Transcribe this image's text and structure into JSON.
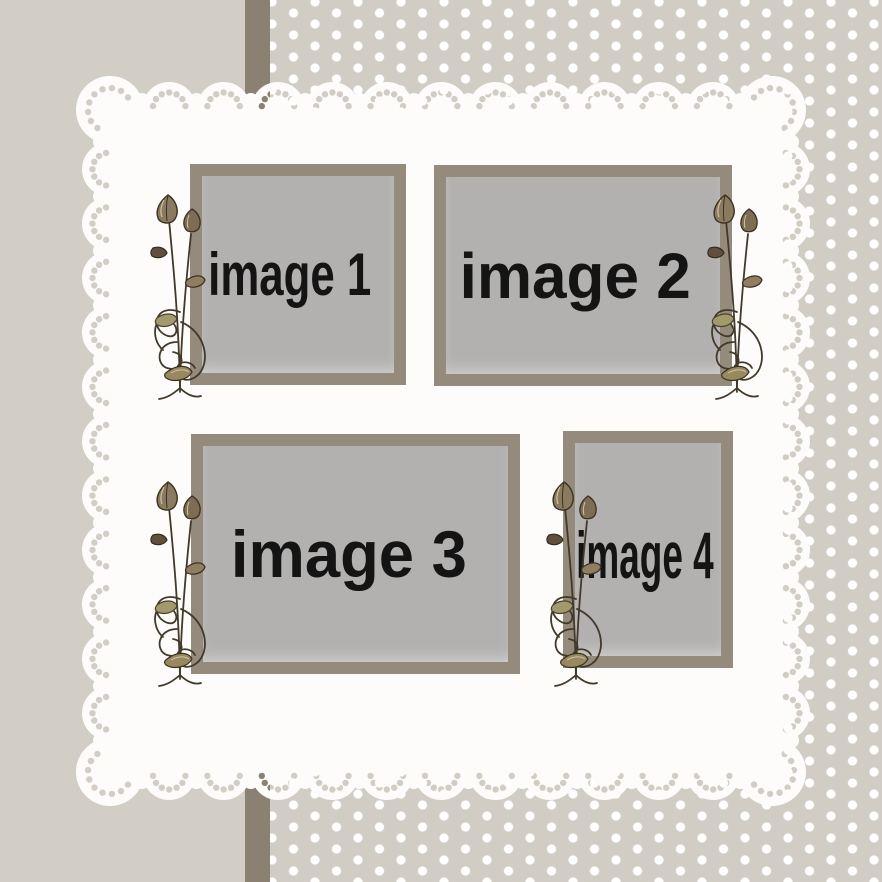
{
  "palette": {
    "background": "#d3cec5",
    "polka_bg": "#d2cdc4",
    "polka_dot": "#ffffff",
    "stripe": "#8b8173",
    "lace": "#fdfcfa",
    "frame_border": "#958b7c",
    "frame_fill": "#b2b1af",
    "label_color": "#141414"
  },
  "frames": [
    {
      "label": "image 1"
    },
    {
      "label": "image 2"
    },
    {
      "label": "image 3"
    },
    {
      "label": "image 4"
    }
  ],
  "icons": {
    "flower": "vine-flower-icon"
  }
}
